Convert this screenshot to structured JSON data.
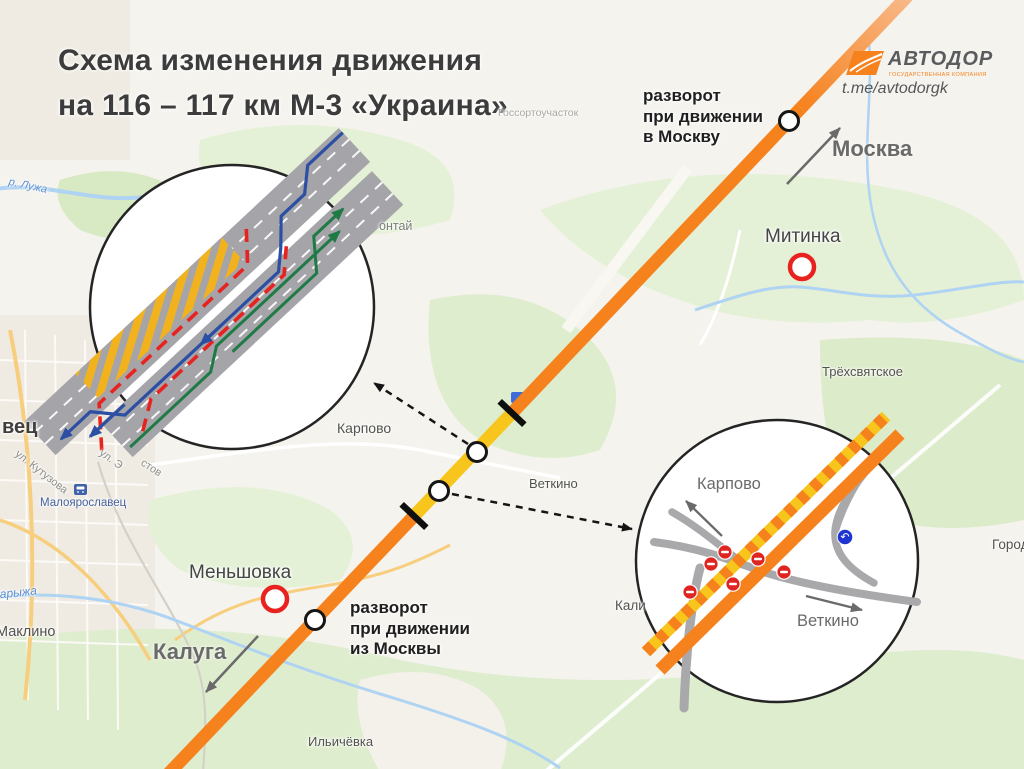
{
  "title": {
    "line1": "Схема изменения движения",
    "line2": "на 116 – 117 км М-3 «Украина»"
  },
  "logo": {
    "brand": "АВТОДОР",
    "tagline": "ГОСУДАРСТВЕННАЯ КОМПАНИЯ",
    "telegram": "t.me/avtodorgk"
  },
  "notes": {
    "to_moscow": {
      "l1": "разворот",
      "l2": "при движении",
      "l3": "в Москву"
    },
    "from_moscow": {
      "l1": "разворот",
      "l2": "при движении",
      "l3": "из Москвы"
    }
  },
  "directions": {
    "moscow": "Москва",
    "kaluga": "Калуга"
  },
  "interchange": {
    "karpovo": "Карпово",
    "vetkino": "Веткино"
  },
  "map_labels": {
    "city_fragment": "вец",
    "street_kutuzova": "ул. Кутузова",
    "street_fragment1": "ул. Э",
    "street_fragment2": "стов",
    "station": "Малоярославец",
    "river_luzha": "р. Лужа",
    "river_karyzha": "Карыжа",
    "maklino": "Маклино",
    "ilyichyovka": "Ильичёвка",
    "karpovo": "Карпово",
    "vetkino": "Веткино",
    "trekhsvyatskoye": "Трёхсвятское",
    "mitinka": "Митинка",
    "menshovka": "Меньшовка",
    "gorode_fragment": "Городе",
    "kali_fragment": "Кали",
    "ontai_fragment": "онтай",
    "gossort": "Госсортоучасток"
  },
  "colors": {
    "highway_orange": "#F6821E",
    "highway_orange_light": "#F8BE93",
    "highway_yellow": "#F8C51C",
    "hatch_yellow": "#F2B21D",
    "work_zone_red": "#E8231F",
    "flow_blue": "#2C4FA3",
    "flow_green": "#1F7A46",
    "roadway_gray": "#A4A4A9",
    "ramp_gray": "#A9A9AC",
    "no_entry_red": "#DF2421",
    "mandatory_sign_blue": "#1F35D2",
    "marker_ring_red": "#E8231F",
    "water_blue": "#AFD3F2",
    "brand_orange": "#F6821E",
    "text_dark": "#3C3C3C",
    "text_gray": "#6A6A6A"
  }
}
